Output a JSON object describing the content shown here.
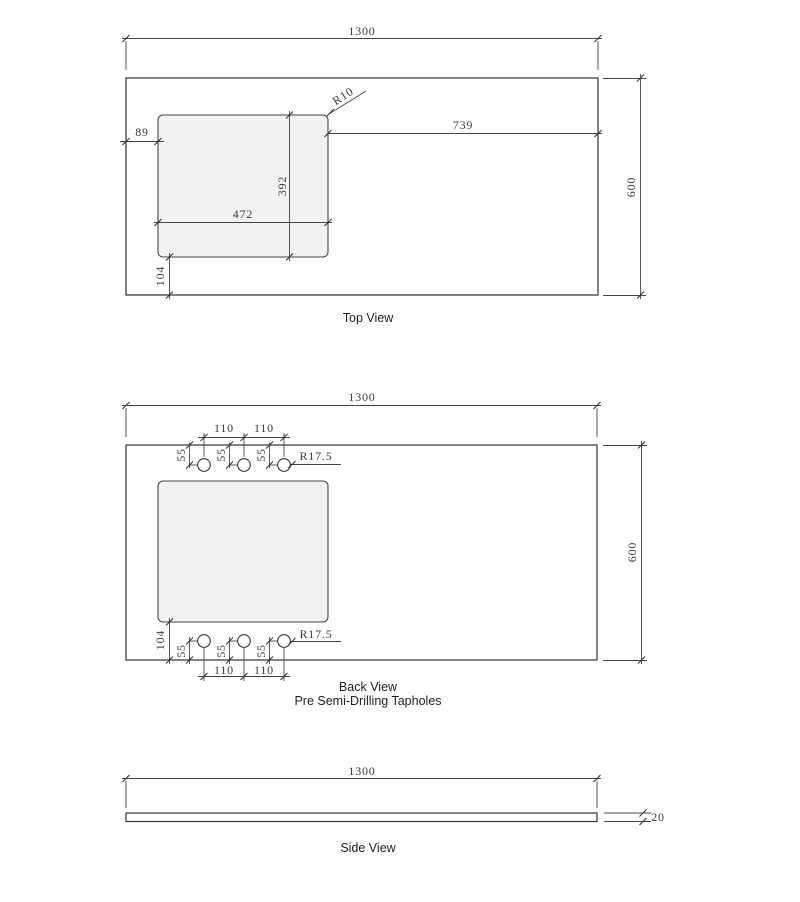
{
  "drawing": {
    "captions": {
      "top": "Top View",
      "back_line1": "Back View",
      "back_line2": "Pre Semi-Drilling Tapholes",
      "side": "Side View"
    },
    "dimensions": {
      "overall_width": "1300",
      "overall_depth": "600",
      "thickness": "20",
      "cutout_width": "472",
      "cutout_depth": "392",
      "cutout_offset_left": "89",
      "cutout_offset_right": "739",
      "cutout_offset_front": "104",
      "cutout_corner_radius": "R10",
      "taphole_spacing": "110",
      "taphole_edge_offset": "55",
      "taphole_radius": "R17.5"
    },
    "colors": {
      "object_line": "#333333",
      "dim_line": "#444444",
      "text": "#3a3a3a",
      "cutout_fill": "#f2f2f2",
      "background": "#ffffff"
    }
  }
}
